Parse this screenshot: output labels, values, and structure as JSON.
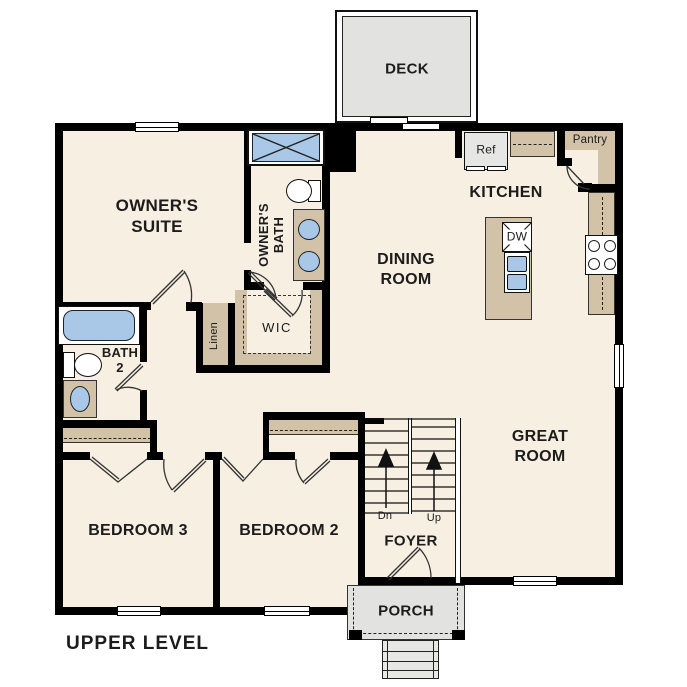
{
  "title": "UPPER LEVEL",
  "labels": {
    "deck": "DECK",
    "porch": "PORCH",
    "foyer": "FOYER",
    "kitchen": "KITCHEN",
    "pantry": "Pantry",
    "ref": "Ref",
    "dw": "DW",
    "dining_room": "DINING\nROOM",
    "great_room": "GREAT\nROOM",
    "owners_suite": "OWNER'S\nSUITE",
    "owners_bath": "OWNER'S\nBATH",
    "bath2": "BATH\n2",
    "wic": "WIC",
    "linen": "Linen",
    "bedroom3": "BEDROOM 3",
    "bedroom2": "BEDROOM 2",
    "stairs_down": "Dn",
    "stairs_up": "Up"
  },
  "colors": {
    "floor": "#f7efe1",
    "wall": "#000000",
    "cabinet_tan": "#d2c3a8",
    "fixture_blue": "#a9c8e8",
    "outdoor_gray": "#e2e2e1",
    "text": "#1c1c1c"
  }
}
